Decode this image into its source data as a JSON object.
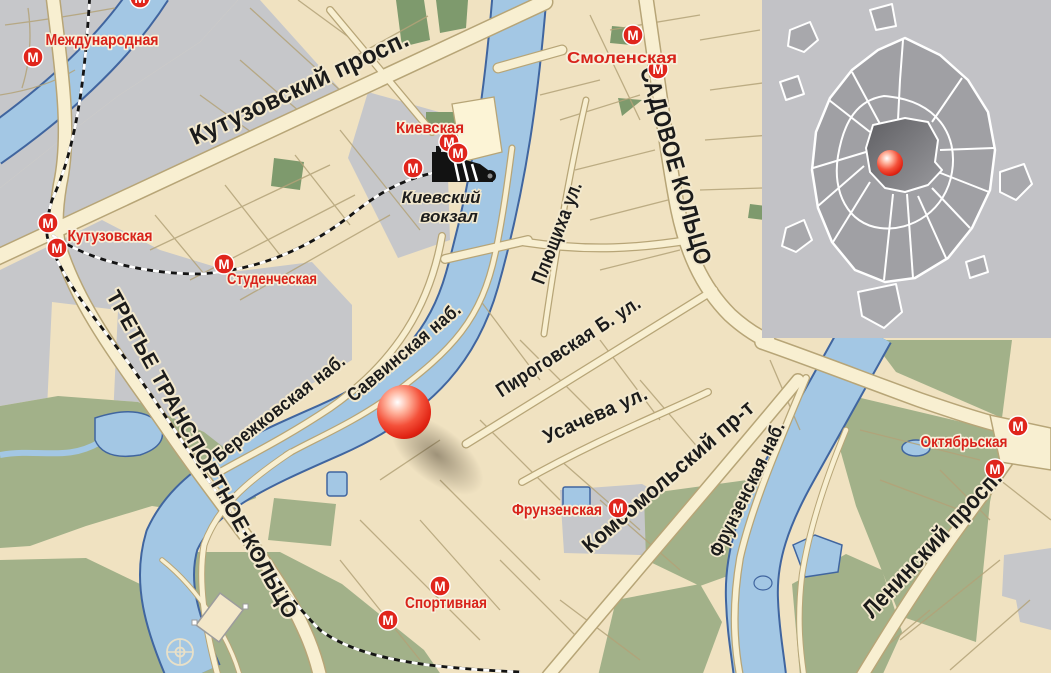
{
  "map": {
    "colors": {
      "land": "#f0e2c1",
      "urban_gray": "#c6c7ca",
      "park_green": "#a2b189",
      "dark_green": "#7e9a6d",
      "water": "#a3c7e4",
      "water_edge": "#40659f",
      "road_fill": "#f8efd1",
      "road_edge": "#b7a577",
      "rail_black": "#141414",
      "metro_red": "#e0251c",
      "street_label": "#1b1b1b",
      "marker_red": "#e02313",
      "inset_bg": "#c2c2c6",
      "inset_city": "#a0a0a4",
      "inset_center_dark": "#5f5f63"
    },
    "street_labels": [
      {
        "text": "Кутузовский просп.",
        "x": 303,
        "y": 95,
        "rot": -25,
        "size": 25,
        "len": 238
      },
      {
        "text": "САДОВОЕ КОЛЬЦО",
        "x": 668,
        "y": 168,
        "rot": 74,
        "size": 24,
        "len": 205
      },
      {
        "text": "Плющиха ул.",
        "x": 563,
        "y": 235,
        "rot": -69,
        "size": 20,
        "len": 108
      },
      {
        "text": "ТРЕТЬЕ ТРАНСПОРТНОЕ КОЛЬЦО",
        "x": 196,
        "y": 458,
        "rot": 61,
        "size": 21,
        "len": 372
      },
      {
        "text": "Бережковская наб.",
        "x": 283,
        "y": 413,
        "rot": -38,
        "size": 19,
        "len": 162
      },
      {
        "text": "Саввинская наб.",
        "x": 408,
        "y": 357,
        "rot": -40,
        "size": 19,
        "len": 142
      },
      {
        "text": "Пироговская Б. ул.",
        "x": 572,
        "y": 352,
        "rot": -33,
        "size": 20,
        "len": 168
      },
      {
        "text": "Усачева ул.",
        "x": 598,
        "y": 421,
        "rot": -24,
        "size": 20,
        "len": 112
      },
      {
        "text": "Комсомольский пр-т",
        "x": 673,
        "y": 482,
        "rot": -41,
        "size": 22,
        "len": 220
      },
      {
        "text": "Фрунзенская наб.",
        "x": 753,
        "y": 492,
        "rot": -64,
        "size": 20,
        "len": 148
      },
      {
        "text": "Ленинский просп.",
        "x": 938,
        "y": 549,
        "rot": -47,
        "size": 24,
        "len": 192
      }
    ],
    "metro": {
      "icon_letter": "М",
      "icon_radius": 10,
      "stations": [
        {
          "name": "Международная",
          "label": {
            "x": 102,
            "y": 45,
            "len": 113
          },
          "icons": [
            [
              33,
              57
            ]
          ]
        },
        {
          "name": "Кутузовская",
          "label": {
            "x": 110,
            "y": 241,
            "len": 85
          },
          "icons": [
            [
              48,
              223
            ],
            [
              57,
              248
            ]
          ]
        },
        {
          "name": "Студенческая",
          "label": {
            "x": 272,
            "y": 284,
            "len": 90
          },
          "icons": [
            [
              224,
              264
            ]
          ]
        },
        {
          "name": "Киевская",
          "label": {
            "x": 430,
            "y": 133,
            "len": 68
          },
          "icons": [
            [
              449,
              142
            ],
            [
              458,
              153
            ],
            [
              413,
              168
            ]
          ]
        },
        {
          "name": "Смоленская",
          "label": {
            "x": 622,
            "y": 63,
            "len": 110
          },
          "icons": [
            [
              633,
              35
            ],
            [
              658,
              69
            ]
          ]
        },
        {
          "name": "Фрунзенская",
          "label": {
            "x": 557,
            "y": 515,
            "len": 90
          },
          "icons": [
            [
              618,
              508
            ]
          ]
        },
        {
          "name": "Спортивная",
          "label": {
            "x": 446,
            "y": 608,
            "len": 82
          },
          "icons": [
            [
              440,
              586
            ],
            [
              388,
              620
            ]
          ]
        },
        {
          "name": "Октябрьская",
          "label": {
            "x": 964,
            "y": 447,
            "len": 87
          },
          "icons": [
            [
              1018,
              426
            ],
            [
              995,
              469
            ]
          ]
        }
      ],
      "edge_icons": [
        [
          140,
          -2
        ]
      ]
    },
    "places": [
      {
        "lines": [
          "Киевский",
          "вокзал"
        ],
        "x": 441,
        "y": 203,
        "line_height": 19,
        "size": 17
      }
    ],
    "location_marker": {
      "x": 404,
      "y": 412,
      "r": 27
    },
    "inset": {
      "marker": {
        "x": 890,
        "y": 163,
        "r": 13
      }
    }
  }
}
